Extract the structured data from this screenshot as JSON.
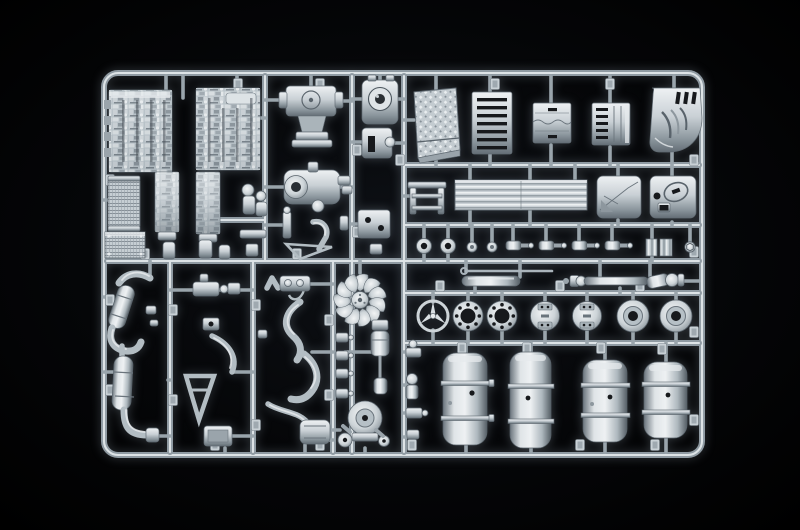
{
  "meta": {
    "type": "photograph",
    "subject": "Injection-molded plastic model kit sprue (parts tree) in light grey styrene, photographed on a black background",
    "kit_theme": "1/24-scale truck components: engine block halves, transmission, cab panels, radiator fan, Mercedes-style star emblem, wheel hubs, fuel tanks, exhaust system",
    "text_visible": "none"
  },
  "palette": {
    "background": "#000000",
    "glow_center": "#0e1116",
    "runner_mid": "#8f9aa2",
    "runner_highlight": "#dde3e6",
    "plastic_highlight": "#eef1f3",
    "plastic_light": "#c9d0d5",
    "plastic_mid": "#aeb8be",
    "plastic_deep": "#8b969d",
    "plastic_dark": "#646e76",
    "slot_dark": "#17191c",
    "pipe_grey": "#b3bdc3"
  },
  "counts": {
    "fuel_tanks": 4,
    "hub_caps": 2,
    "bolt_flanges": 2,
    "tank_end_caps": 2,
    "shock_absorbers": 4,
    "fan_blades": 11,
    "filler_caps": 2
  },
  "parts": [
    {
      "name": "sprue-frame",
      "label": "outer rectangular runner frame with rounded corners"
    },
    {
      "name": "runner-lattice",
      "label": "internal runner bars dividing the sprue into sections"
    },
    {
      "name": "engine-block-half-left",
      "label": "engine block half, left"
    },
    {
      "name": "engine-block-half-right",
      "label": "engine block half, right"
    },
    {
      "name": "engine-lower-left",
      "label": "engine lower crankcase half"
    },
    {
      "name": "engine-lower-right",
      "label": "engine lower crankcase half"
    },
    {
      "name": "radiator",
      "label": "radiator core with mesh texture"
    },
    {
      "name": "intercooler",
      "label": "intercooler block"
    },
    {
      "name": "water-pump",
      "label": "water pump assembly"
    },
    {
      "name": "bell-housing",
      "label": "transmission bell housing"
    },
    {
      "name": "oil-filter-housing",
      "label": "round-dial housing"
    },
    {
      "name": "steering-gearbox",
      "label": "steering gearbox"
    },
    {
      "name": "transfer-case",
      "label": "transfer case with round bore"
    },
    {
      "name": "diamond-plate-panel",
      "label": "chequer-plate deck panel"
    },
    {
      "name": "slatted-panel",
      "label": "grille panel with dark slats"
    },
    {
      "name": "battery-cover-a",
      "label": "battery box cover"
    },
    {
      "name": "battery-cover-b",
      "label": "vented box cover"
    },
    {
      "name": "cab-fender",
      "label": "curved cab corner / fender with louvers"
    },
    {
      "name": "step-bracket",
      "label": "ladder-style step bracket"
    },
    {
      "name": "tread-plate",
      "label": "long ribbed tread plate"
    },
    {
      "name": "panel-square-left",
      "label": "square panel with creases"
    },
    {
      "name": "panel-square-right",
      "label": "square panel with circular recess"
    },
    {
      "name": "filler-caps",
      "label": "pair of round filler caps"
    },
    {
      "name": "shock-absorbers",
      "label": "row of four shock absorbers"
    },
    {
      "name": "ribbed-couplers",
      "label": "two ribbed coupler blocks"
    },
    {
      "name": "hex-fitting",
      "label": "small hex ring fitting"
    },
    {
      "name": "control-rod",
      "label": "long thin control rod"
    },
    {
      "name": "air-reservoir",
      "label": "smooth air reservoir cylinder"
    },
    {
      "name": "drive-shaft",
      "label": "drive shaft with universal joints"
    },
    {
      "name": "mercedes-star-emblem",
      "label": "three-pointed star in ring"
    },
    {
      "name": "bolt-flanges",
      "label": "two flanges with bolt-hole circles"
    },
    {
      "name": "tank-end-caps",
      "label": "two tank end caps with fittings"
    },
    {
      "name": "hub-caps",
      "label": "two wheel hub caps"
    },
    {
      "name": "fuel-tanks",
      "label": "four cylindrical fuel tanks with straps"
    },
    {
      "name": "exhaust-upper",
      "label": "exhaust pipe with angled muffler"
    },
    {
      "name": "exhaust-lower",
      "label": "vertical muffler with elbow outlet"
    },
    {
      "name": "valve-block",
      "label": "valve block with ports"
    },
    {
      "name": "coolant-hoses",
      "label": "curved coolant hoses"
    },
    {
      "name": "a-frame-bracket",
      "label": "triangular A-frame bracket"
    },
    {
      "name": "mounting-plate",
      "label": "small mounting plate"
    },
    {
      "name": "radiator-fan",
      "label": "multi-blade radiator fan"
    },
    {
      "name": "filter-assembly",
      "label": "fuel filter column"
    },
    {
      "name": "air-compressor",
      "label": "air compressor with pulleys"
    },
    {
      "name": "small-valves",
      "label": "column of small valves"
    },
    {
      "name": "part-number-tabs",
      "label": "embossed part-number tabs on runners"
    }
  ]
}
